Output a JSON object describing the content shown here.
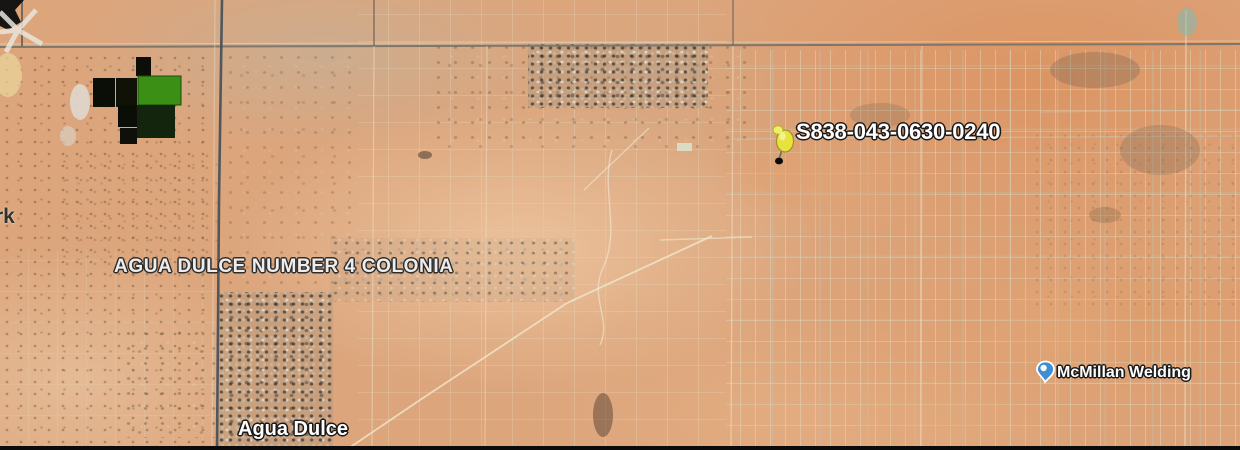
{
  "map": {
    "view": "satellite-imagery",
    "labels": {
      "parcel": "S838-043-0630-0240",
      "colonia": "AGUA DULCE NUMBER 4 COLONIA",
      "town": "Agua Dulce",
      "business": "McMillan Welding",
      "edge_partial": "rk"
    },
    "markers": {
      "pushpin": {
        "icon": "yellow-pushpin-icon",
        "color": "#e8e33c"
      },
      "business": {
        "icon": "blue-place-marker-icon",
        "color": "#3f8ed0"
      }
    },
    "colors": {
      "desert_base": "#dca57c",
      "road_dark": "#49525b",
      "parcel_line": "#e8dfc0",
      "field_green": "#3b8f14",
      "field_dark": "#0c0e08",
      "label_text": "#ffffff",
      "label_outline": "#1a1a1a"
    }
  }
}
